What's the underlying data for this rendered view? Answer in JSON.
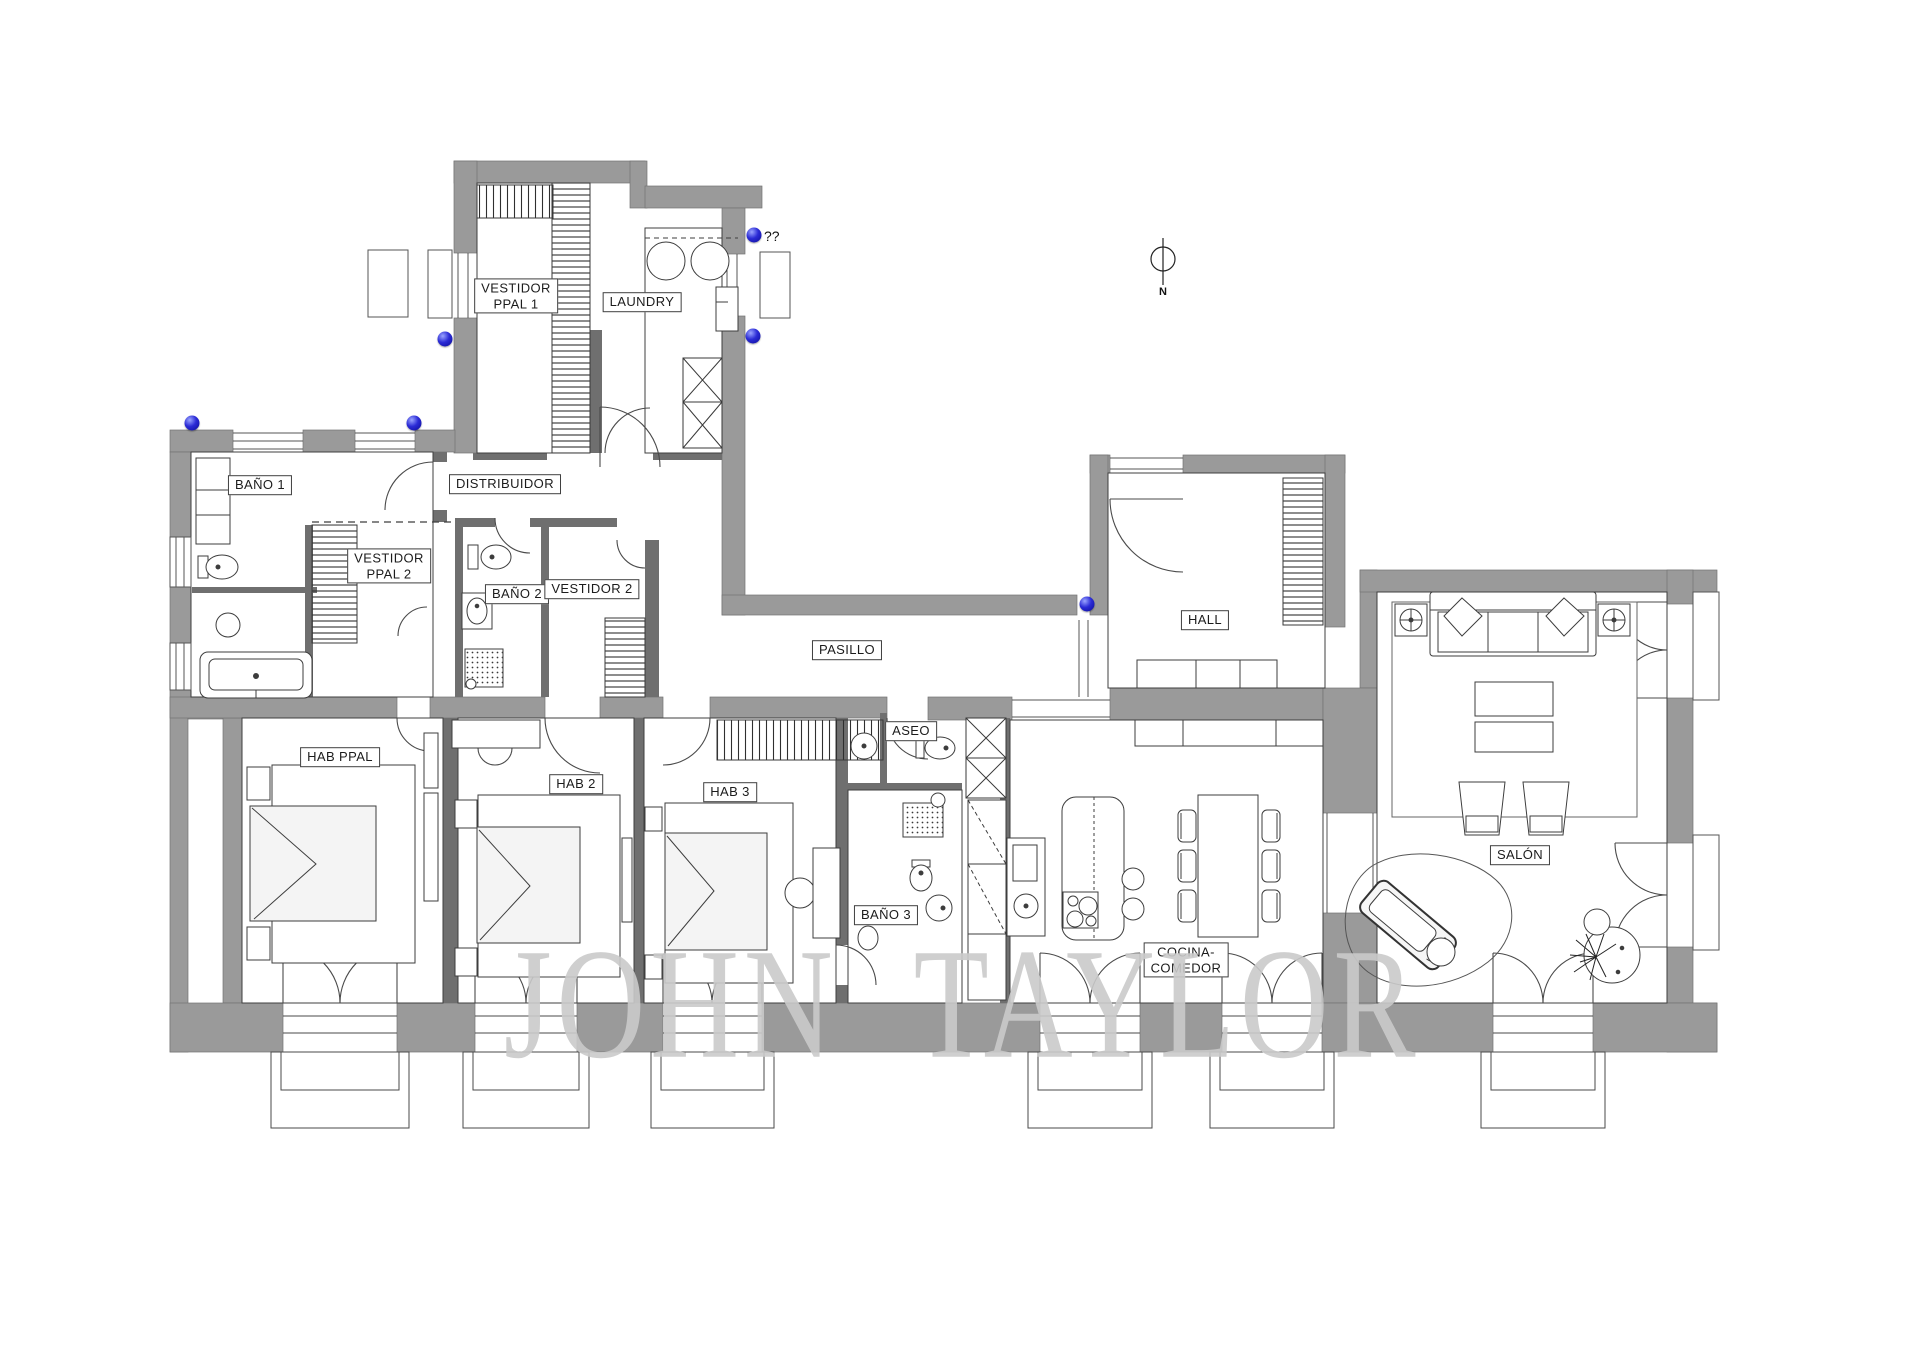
{
  "watermark": "JOHN TAYLOR",
  "compass": {
    "label": "N",
    "x": 1163,
    "y": 291
  },
  "annotation": {
    "question_marks": "??",
    "x": 764,
    "y": 236
  },
  "colors": {
    "wall": "#9a9a9a",
    "partition": "#6f6f6f",
    "line": "#444444",
    "marker_blue": "#1a1acc",
    "watermark_gray": "#cacaca",
    "background": "#ffffff"
  },
  "rooms": [
    {
      "id": "vestidor-ppal-1",
      "lines": [
        "VESTIDOR",
        "PPAL 1"
      ],
      "x": 516,
      "y": 296
    },
    {
      "id": "laundry",
      "lines": [
        "LAUNDRY"
      ],
      "x": 642,
      "y": 302
    },
    {
      "id": "bano-1",
      "lines": [
        "BAÑO 1"
      ],
      "x": 260,
      "y": 485
    },
    {
      "id": "distribuidor",
      "lines": [
        "DISTRIBUIDOR"
      ],
      "x": 505,
      "y": 484
    },
    {
      "id": "vestidor-ppal-2",
      "lines": [
        "VESTIDOR",
        "PPAL 2"
      ],
      "x": 389,
      "y": 566
    },
    {
      "id": "bano-2",
      "lines": [
        "BAÑO 2"
      ],
      "x": 517,
      "y": 594
    },
    {
      "id": "vestidor-2",
      "lines": [
        "VESTIDOR 2"
      ],
      "x": 592,
      "y": 589
    },
    {
      "id": "pasillo",
      "lines": [
        "PASILLO"
      ],
      "x": 847,
      "y": 650
    },
    {
      "id": "hall",
      "lines": [
        "HALL"
      ],
      "x": 1205,
      "y": 620
    },
    {
      "id": "aseo",
      "lines": [
        "ASEO"
      ],
      "x": 911,
      "y": 731
    },
    {
      "id": "hab-ppal",
      "lines": [
        "HAB PPAL"
      ],
      "x": 340,
      "y": 757
    },
    {
      "id": "hab-2",
      "lines": [
        "HAB 2"
      ],
      "x": 576,
      "y": 784
    },
    {
      "id": "hab-3",
      "lines": [
        "HAB 3"
      ],
      "x": 730,
      "y": 792
    },
    {
      "id": "bano-3",
      "lines": [
        "BAÑO 3"
      ],
      "x": 886,
      "y": 915
    },
    {
      "id": "cocina-comedor",
      "lines": [
        "COCINA-",
        "COMEDOR"
      ],
      "x": 1186,
      "y": 960
    },
    {
      "id": "salon",
      "lines": [
        "SALÓN"
      ],
      "x": 1520,
      "y": 855
    }
  ],
  "markers": [
    {
      "x": 754,
      "y": 235
    },
    {
      "x": 753,
      "y": 336
    },
    {
      "x": 445,
      "y": 339
    },
    {
      "x": 192,
      "y": 423
    },
    {
      "x": 414,
      "y": 423
    },
    {
      "x": 1087,
      "y": 604
    }
  ]
}
